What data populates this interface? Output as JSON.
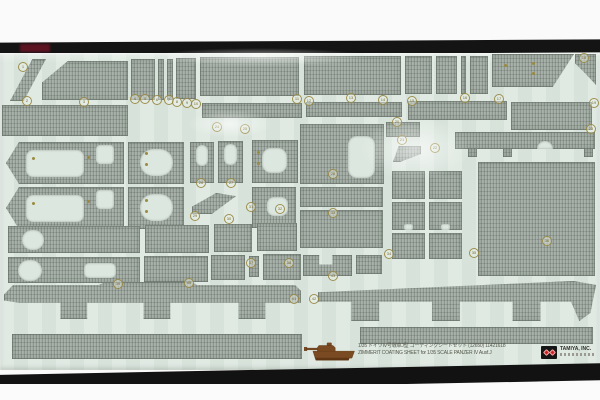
{
  "photo": {
    "top_margin_color": "#fafafa",
    "film_band_color": "#141414",
    "film_band_red_color": "#5c1322",
    "bottom_margin_color": "#fbfbfb"
  },
  "colors": {
    "sheet_bg": "#dce7df",
    "piece_gray": "#a3ada5",
    "marker_gold": "#9b8b3e",
    "tank_brown": "#7a4a22",
    "logo_red": "#cc2222",
    "caption_text": "#55584a"
  },
  "caption": {
    "line1": "1/35 ドイツⅣ号戦車J型 コーティングシートセット (12650) 11421618",
    "line2": "ZIMMERIT COATING SHEET for 1/35 SCALE PANZER IV Ausf.J",
    "brand": "TAMIYA, INC."
  },
  "sheet": {
    "pieces": [
      {
        "x": 10,
        "y": 59,
        "w": 36,
        "h": 42,
        "clip": "polygon(62% 0,100% 0,38% 100%,0 100%)"
      },
      {
        "x": 42,
        "y": 61,
        "w": 86,
        "h": 39,
        "clip": "polygon(0 55%,30% 0,100% 0,100% 100%,0 100%)"
      },
      {
        "x": 131,
        "y": 59,
        "w": 24,
        "h": 41
      },
      {
        "x": 158,
        "y": 59,
        "w": 6,
        "h": 41
      },
      {
        "x": 167,
        "y": 59,
        "w": 6,
        "h": 41
      },
      {
        "x": 176,
        "y": 58,
        "w": 20,
        "h": 41
      },
      {
        "x": 200,
        "y": 57,
        "w": 99,
        "h": 39
      },
      {
        "x": 304,
        "y": 56,
        "w": 97,
        "h": 39
      },
      {
        "x": 405,
        "y": 56,
        "w": 27,
        "h": 38
      },
      {
        "x": 436,
        "y": 56,
        "w": 21,
        "h": 38
      },
      {
        "x": 461,
        "y": 56,
        "w": 5,
        "h": 38
      },
      {
        "x": 470,
        "y": 56,
        "w": 18,
        "h": 38
      },
      {
        "x": 492,
        "y": 54,
        "w": 82,
        "h": 33,
        "clip": "polygon(0 0,100% 0,74% 100%,0 100%)"
      },
      {
        "x": 575,
        "y": 54,
        "w": 21,
        "h": 31,
        "clip": "polygon(0 0,100% 0,100% 100%,45% 60%,0 30%)"
      },
      {
        "x": 2,
        "y": 105,
        "w": 126,
        "h": 31
      },
      {
        "x": 202,
        "y": 103,
        "w": 100,
        "h": 15
      },
      {
        "x": 306,
        "y": 102,
        "w": 96,
        "h": 15
      },
      {
        "x": 408,
        "y": 101,
        "w": 99,
        "h": 19
      },
      {
        "x": 511,
        "y": 102,
        "w": 81,
        "h": 28
      },
      {
        "x": 386,
        "y": 122,
        "w": 34,
        "h": 15
      },
      {
        "x": 393,
        "y": 146,
        "w": 28,
        "h": 16,
        "clip": "polygon(0 100%,20% 0,100% 0,100% 50%,25% 100%)"
      },
      {
        "x": 6,
        "y": 142,
        "w": 118,
        "h": 42,
        "clip": "polygon(0 50%,11% 0,100% 0,100% 100%,11% 100%)",
        "holes": [
          {
            "x": 20,
            "y": 8,
            "w": 58,
            "h": 27,
            "r": 7
          },
          {
            "x": 90,
            "y": 3,
            "w": 18,
            "h": 19,
            "r": 4
          }
        ]
      },
      {
        "x": 6,
        "y": 187,
        "w": 118,
        "h": 42,
        "clip": "polygon(0 50%,11% 0,100% 0,100% 100%,11% 100%)",
        "holes": [
          {
            "x": 20,
            "y": 8,
            "w": 58,
            "h": 27,
            "r": 7
          },
          {
            "x": 90,
            "y": 3,
            "w": 18,
            "h": 19,
            "r": 4
          }
        ]
      },
      {
        "x": 128,
        "y": 142,
        "w": 56,
        "h": 42,
        "holes": [
          {
            "x": 12,
            "y": 7,
            "w": 33,
            "h": 27,
            "r": 13
          }
        ]
      },
      {
        "x": 128,
        "y": 187,
        "w": 56,
        "h": 42,
        "holes": [
          {
            "x": 12,
            "y": 7,
            "w": 33,
            "h": 27,
            "r": 13
          }
        ]
      },
      {
        "x": 190,
        "y": 142,
        "w": 24,
        "h": 41,
        "holes": [
          {
            "x": 6,
            "y": 3,
            "w": 12,
            "h": 21,
            "r": 6
          }
        ]
      },
      {
        "x": 218,
        "y": 141,
        "w": 25,
        "h": 42,
        "holes": [
          {
            "x": 6,
            "y": 3,
            "w": 13,
            "h": 21,
            "r": 6
          }
        ]
      },
      {
        "x": 192,
        "y": 193,
        "w": 44,
        "h": 21,
        "clip": "polygon(0 65%,55% 0,100% 15%,45% 100%,0 100%)"
      },
      {
        "x": 252,
        "y": 140,
        "w": 46,
        "h": 43,
        "holes": [
          {
            "x": 10,
            "y": 8,
            "w": 25,
            "h": 25,
            "r": 9
          }
        ]
      },
      {
        "x": 252,
        "y": 187,
        "w": 44,
        "h": 41,
        "holes": [
          {
            "x": 15,
            "y": 10,
            "w": 21,
            "h": 19,
            "r": 7
          }
        ]
      },
      {
        "x": 300,
        "y": 124,
        "w": 84,
        "h": 60,
        "holes": [
          {
            "x": 48,
            "y": 12,
            "w": 27,
            "h": 42,
            "r": 9
          }
        ]
      },
      {
        "x": 300,
        "y": 187,
        "w": 83,
        "h": 20
      },
      {
        "x": 300,
        "y": 210,
        "w": 83,
        "h": 38
      },
      {
        "x": 392,
        "y": 171,
        "w": 33,
        "h": 28
      },
      {
        "x": 429,
        "y": 171,
        "w": 33,
        "h": 28
      },
      {
        "x": 392,
        "y": 202,
        "w": 33,
        "h": 28,
        "holes": [
          {
            "x": 12,
            "y": 22,
            "w": 9,
            "h": 6,
            "r": 2
          }
        ]
      },
      {
        "x": 429,
        "y": 202,
        "w": 33,
        "h": 28,
        "holes": [
          {
            "x": 12,
            "y": 22,
            "w": 9,
            "h": 6,
            "r": 2
          }
        ]
      },
      {
        "x": 392,
        "y": 233,
        "w": 33,
        "h": 26
      },
      {
        "x": 429,
        "y": 233,
        "w": 33,
        "h": 26
      },
      {
        "x": 455,
        "y": 132,
        "w": 140,
        "h": 17,
        "holes": [
          {
            "x": 82,
            "y": 9,
            "w": 16,
            "h": 8,
            "r": "8px 8px 0 0"
          }
        ]
      },
      {
        "x": 468,
        "y": 148,
        "w": 9,
        "h": 9
      },
      {
        "x": 503,
        "y": 148,
        "w": 9,
        "h": 9
      },
      {
        "x": 584,
        "y": 148,
        "w": 9,
        "h": 9
      },
      {
        "x": 478,
        "y": 162,
        "w": 117,
        "h": 114
      },
      {
        "x": 8,
        "y": 226,
        "w": 132,
        "h": 27,
        "holes": [
          {
            "x": 14,
            "y": 4,
            "w": 22,
            "h": 20,
            "r": 11
          }
        ]
      },
      {
        "x": 145,
        "y": 225,
        "w": 64,
        "h": 28
      },
      {
        "x": 214,
        "y": 224,
        "w": 38,
        "h": 28
      },
      {
        "x": 257,
        "y": 223,
        "w": 40,
        "h": 28
      },
      {
        "x": 8,
        "y": 257,
        "w": 132,
        "h": 26,
        "holes": [
          {
            "x": 10,
            "y": 3,
            "w": 24,
            "h": 21,
            "r": 12
          },
          {
            "x": 76,
            "y": 6,
            "w": 32,
            "h": 15,
            "r": 5
          }
        ]
      },
      {
        "x": 144,
        "y": 256,
        "w": 64,
        "h": 26
      },
      {
        "x": 211,
        "y": 255,
        "w": 34,
        "h": 25
      },
      {
        "x": 249,
        "y": 256,
        "w": 10,
        "h": 21
      },
      {
        "x": 263,
        "y": 254,
        "w": 38,
        "h": 26
      },
      {
        "x": 303,
        "y": 255,
        "w": 49,
        "h": 21,
        "clip": "polygon(0 0,33% 0,33% 45%,60% 45%,60% 0,100% 0,100% 100%,0 100%)"
      },
      {
        "x": 356,
        "y": 255,
        "w": 26,
        "h": 19
      },
      {
        "x": 4,
        "y": 282,
        "w": 297,
        "h": 37,
        "clip": "polygon(0 34%,3% 8%,32% 8%,34% 0,63% 0,65% 8%,98% 8%,100% 24%,100% 56%,88% 56%,88% 100%,79% 100%,79% 56%,56% 56%,56% 100%,47% 100%,47% 56%,28% 56%,28% 100%,19% 100%,19% 56%,5% 56%,0 50%)"
      },
      {
        "x": 318,
        "y": 281,
        "w": 278,
        "h": 40,
        "clip": "polygon(0 28%,92% 0,100% 10%,98% 80%,94% 100%,91% 52%,80% 52%,80% 100%,70% 100%,70% 52%,51% 52%,51% 100%,41% 100%,41% 52%,22% 52%,22% 100%,12% 100%,12% 52%,0 52%)"
      },
      {
        "x": 12,
        "y": 334,
        "w": 290,
        "h": 25
      },
      {
        "x": 360,
        "y": 327,
        "w": 233,
        "h": 17
      }
    ],
    "part_markers": [
      {
        "x": 22,
        "y": 66,
        "n": "1"
      },
      {
        "x": 26,
        "y": 100,
        "n": "2"
      },
      {
        "x": 83,
        "y": 101,
        "n": "3"
      },
      {
        "x": 134,
        "y": 98,
        "n": "4"
      },
      {
        "x": 144,
        "y": 98,
        "n": "5"
      },
      {
        "x": 156,
        "y": 99,
        "n": "6"
      },
      {
        "x": 168,
        "y": 99,
        "n": "7"
      },
      {
        "x": 176,
        "y": 101,
        "n": "8"
      },
      {
        "x": 186,
        "y": 102,
        "n": "9"
      },
      {
        "x": 195,
        "y": 103,
        "n": "10"
      },
      {
        "x": 296,
        "y": 98,
        "n": "11"
      },
      {
        "x": 308,
        "y": 100,
        "n": "12"
      },
      {
        "x": 350,
        "y": 97,
        "n": "13"
      },
      {
        "x": 382,
        "y": 99,
        "n": "14"
      },
      {
        "x": 411,
        "y": 100,
        "n": "15"
      },
      {
        "x": 464,
        "y": 97,
        "n": "16"
      },
      {
        "x": 498,
        "y": 98,
        "n": "17"
      },
      {
        "x": 583,
        "y": 57,
        "n": "18"
      },
      {
        "x": 593,
        "y": 102,
        "n": "19"
      },
      {
        "x": 396,
        "y": 121,
        "n": "20"
      },
      {
        "x": 401,
        "y": 139,
        "n": "21"
      },
      {
        "x": 434,
        "y": 147,
        "n": "22"
      },
      {
        "x": 590,
        "y": 128,
        "n": "23"
      },
      {
        "x": 216,
        "y": 126,
        "n": "24"
      },
      {
        "x": 244,
        "y": 128,
        "n": "25"
      },
      {
        "x": 200,
        "y": 182,
        "n": "26"
      },
      {
        "x": 230,
        "y": 182,
        "n": "27"
      },
      {
        "x": 332,
        "y": 173,
        "n": "28"
      },
      {
        "x": 194,
        "y": 215,
        "n": "29"
      },
      {
        "x": 228,
        "y": 218,
        "n": "30"
      },
      {
        "x": 250,
        "y": 206,
        "n": "31"
      },
      {
        "x": 279,
        "y": 208,
        "n": "32"
      },
      {
        "x": 332,
        "y": 212,
        "n": "33"
      },
      {
        "x": 388,
        "y": 253,
        "n": "34"
      },
      {
        "x": 473,
        "y": 252,
        "n": "35"
      },
      {
        "x": 546,
        "y": 240,
        "n": "36"
      },
      {
        "x": 250,
        "y": 262,
        "n": "37"
      },
      {
        "x": 288,
        "y": 262,
        "n": "38"
      },
      {
        "x": 117,
        "y": 283,
        "n": "39"
      },
      {
        "x": 188,
        "y": 282,
        "n": "40"
      },
      {
        "x": 293,
        "y": 298,
        "n": "41"
      },
      {
        "x": 313,
        "y": 298,
        "n": "42"
      },
      {
        "x": 332,
        "y": 275,
        "n": "43"
      }
    ],
    "punch_dots": [
      {
        "x": 33,
        "y": 158
      },
      {
        "x": 88,
        "y": 157
      },
      {
        "x": 33,
        "y": 203
      },
      {
        "x": 88,
        "y": 201
      },
      {
        "x": 146,
        "y": 153
      },
      {
        "x": 146,
        "y": 164
      },
      {
        "x": 146,
        "y": 200
      },
      {
        "x": 146,
        "y": 211
      },
      {
        "x": 258,
        "y": 152
      },
      {
        "x": 258,
        "y": 163
      },
      {
        "x": 505,
        "y": 65
      },
      {
        "x": 533,
        "y": 63
      },
      {
        "x": 533,
        "y": 73
      }
    ],
    "glares": [
      {
        "x": 360,
        "y": 118,
        "w": 110,
        "h": 62
      },
      {
        "x": 150,
        "y": 48,
        "w": 220,
        "h": 18
      },
      {
        "x": 188,
        "y": 110,
        "w": 84,
        "h": 28
      }
    ]
  }
}
